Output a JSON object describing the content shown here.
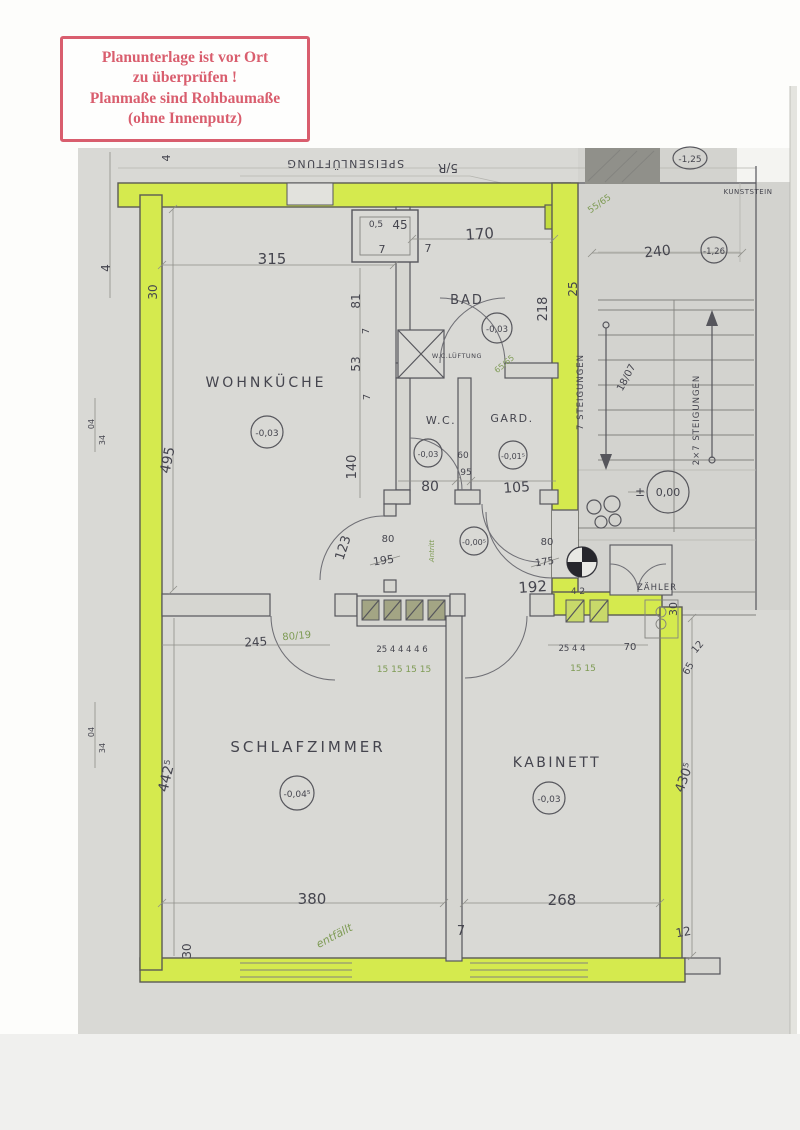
{
  "stamp": {
    "line1": "Planunterlage ist vor Ort",
    "line2": "zu überprüfen !",
    "line3": "Planmaße sind Rohbaumaße",
    "line4": "(ohne Innenputz)"
  },
  "colors": {
    "stamp_red": "#d95e6e",
    "highlight_green": "#d5ea4e",
    "ink": "#4b4b54",
    "pencil_green": "#7e9b54",
    "paper": "#d9d9d5"
  },
  "rooms": {
    "wohnkueche": {
      "name": "WOHNKÜCHE",
      "level": "-0,03"
    },
    "bad": {
      "name": "BAD",
      "level": "-0,03"
    },
    "wc": {
      "name": "W.C.",
      "level": "-0,03"
    },
    "garderobe": {
      "name": "GARD.",
      "level": "-0,01⁵"
    },
    "vorraum": {
      "level": "-0,00⁵"
    },
    "schlafzimmer": {
      "name": "SCHLAFZIMMER",
      "level": "-0,04⁵"
    },
    "kabinett": {
      "name": "KABINETT",
      "level": "-0,03"
    }
  },
  "stair": {
    "flight1": "7 STEIGUNGEN",
    "flight2": "2×7 STEIGUNGEN",
    "step_note": "18/07",
    "level_zero": "0,00",
    "plus_minus": "±",
    "level_m125": "-1,25",
    "level_m126": "-1,26",
    "material": "KUNSTSTEIN",
    "duct": "SPEISENLÜFTUNG",
    "ref": "5/R"
  },
  "meter": {
    "label": "ZÄHLER"
  },
  "notes": {
    "entfaellt": "entfällt",
    "antritt": "Antritt",
    "wc_lueftung": "W.C.LÜFTUNG"
  },
  "dims": {
    "d315": "315",
    "d170": "170",
    "d240": "240",
    "d495": "495",
    "d140": "140",
    "d81": "81",
    "d53": "53",
    "d7": "7",
    "d30": "30",
    "d25": "25",
    "d4": "4",
    "d45": "45",
    "d05": "0,5",
    "d218": "218",
    "d80": "80",
    "d105": "105",
    "d60": "60",
    "d95": "95",
    "d6565": "65/65",
    "d5565": "55/65",
    "d123": "123",
    "d195": "195",
    "d175": "175",
    "d192": "192",
    "d8019": "80/19",
    "d245": "245",
    "flue_left": "25 4 4 4 4 6",
    "flue_left2": "15 15 15 15",
    "flue_right": "25 4 4",
    "flue_right2": "15 15",
    "d70": "70",
    "d42": "4 2",
    "d65": "65",
    "d12": "12",
    "d4425": "442⁵",
    "d4305": "430⁵",
    "d380": "380",
    "d268": "268",
    "d04": "04",
    "d34": "34"
  }
}
